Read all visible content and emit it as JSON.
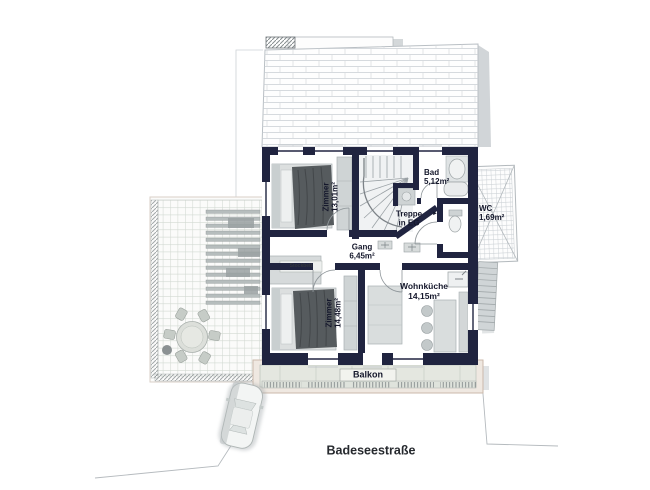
{
  "street": {
    "label": "Badeseestraße"
  },
  "balcony": {
    "label": "Balkon"
  },
  "rooms": {
    "zimmer_top": {
      "name": "Zimmer",
      "area": "13,01m²"
    },
    "bad": {
      "name": "Bad",
      "area": "5,12m²"
    },
    "treppe": {
      "line1": "Treppe",
      "line2": "in EG"
    },
    "wc": {
      "name": "WC",
      "area": "1,69m²"
    },
    "gang": {
      "name": "Gang",
      "area": "6,45m²"
    },
    "zimmer_bottom": {
      "name": "Zimmer",
      "area": "14,48m²"
    },
    "wohnkueche": {
      "name": "Wohnküche",
      "area": "14,15m²"
    }
  },
  "furniture": {
    "stockbett_label": "Stockbett"
  },
  "icons": {
    "stairs_direction_arrow": "►"
  },
  "colors": {
    "page": "#ffffff",
    "wall": "#202440",
    "text": "#14172b",
    "street_text": "#26292e",
    "blanket": "#565b5e",
    "furniture": "#d7dbdb",
    "roof_line": "#c9ced3",
    "balcony_frame": "#efe8e1",
    "balcony_deck": "#e4e7e0",
    "terrace_line": "#ccd4cc",
    "shadow": "#c2c7cb"
  }
}
